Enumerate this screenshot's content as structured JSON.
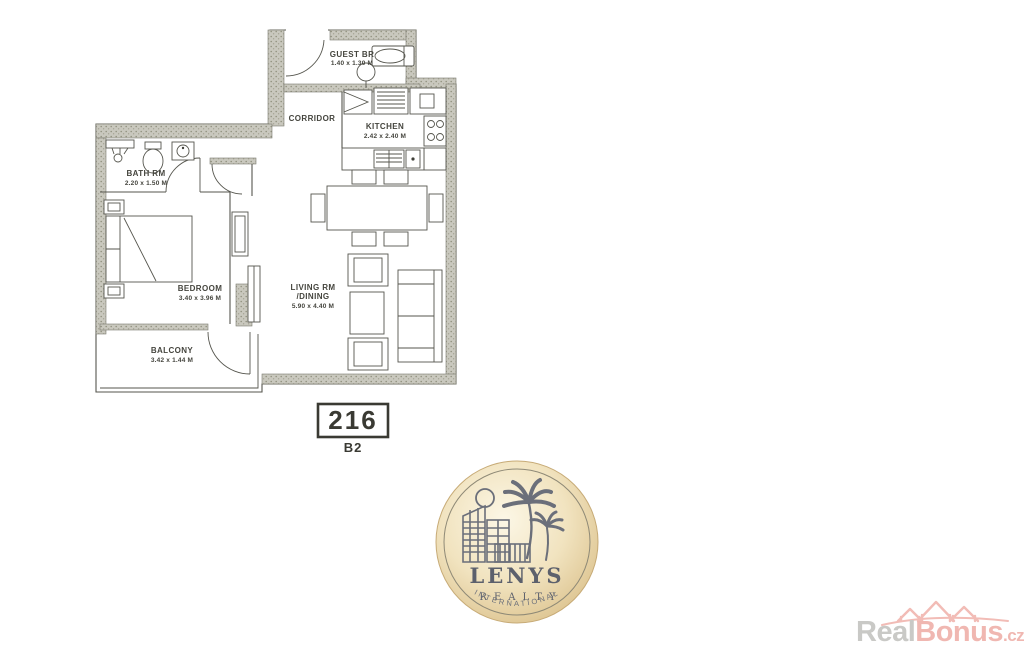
{
  "floorplan": {
    "unit": {
      "number": "216",
      "variant": "B2"
    },
    "rooms": {
      "guest_br": {
        "name": "GUEST BR",
        "dims": "1.40 x 1.30 M"
      },
      "corridor": {
        "name": "CORRIDOR"
      },
      "kitchen": {
        "name": "KITCHEN",
        "dims": "2.42 x 2.40 M"
      },
      "bath": {
        "name": "BATH RM",
        "dims": "2.20 x 1.50 M"
      },
      "bedroom": {
        "name": "BEDROOM",
        "dims": "3.40 x 3.96 M"
      },
      "living": {
        "name": "LIVING RM",
        "name2": "/DINING",
        "dims": "5.90 x 4.40 M"
      },
      "balcony": {
        "name": "BALCONY",
        "dims": "3.42 x 1.44 M"
      }
    }
  },
  "logo": {
    "brand": "LENYS",
    "division": "REALTY",
    "tagline": "INTERNATIONAL",
    "icons": [
      "buildings-icon",
      "palm-trees-icon",
      "sun-icon"
    ],
    "colors": {
      "gold_light": "#fcf7e6",
      "gold_dark": "#d2b57c",
      "ink": "#5c606c"
    }
  },
  "watermark": {
    "text_gray": "Real",
    "text_pink": "Bonus",
    "text_suffix": ".cz",
    "icon": "houses-icon",
    "colors": {
      "gray": "#c9c9c6",
      "pink": "#f0b7b1"
    }
  }
}
